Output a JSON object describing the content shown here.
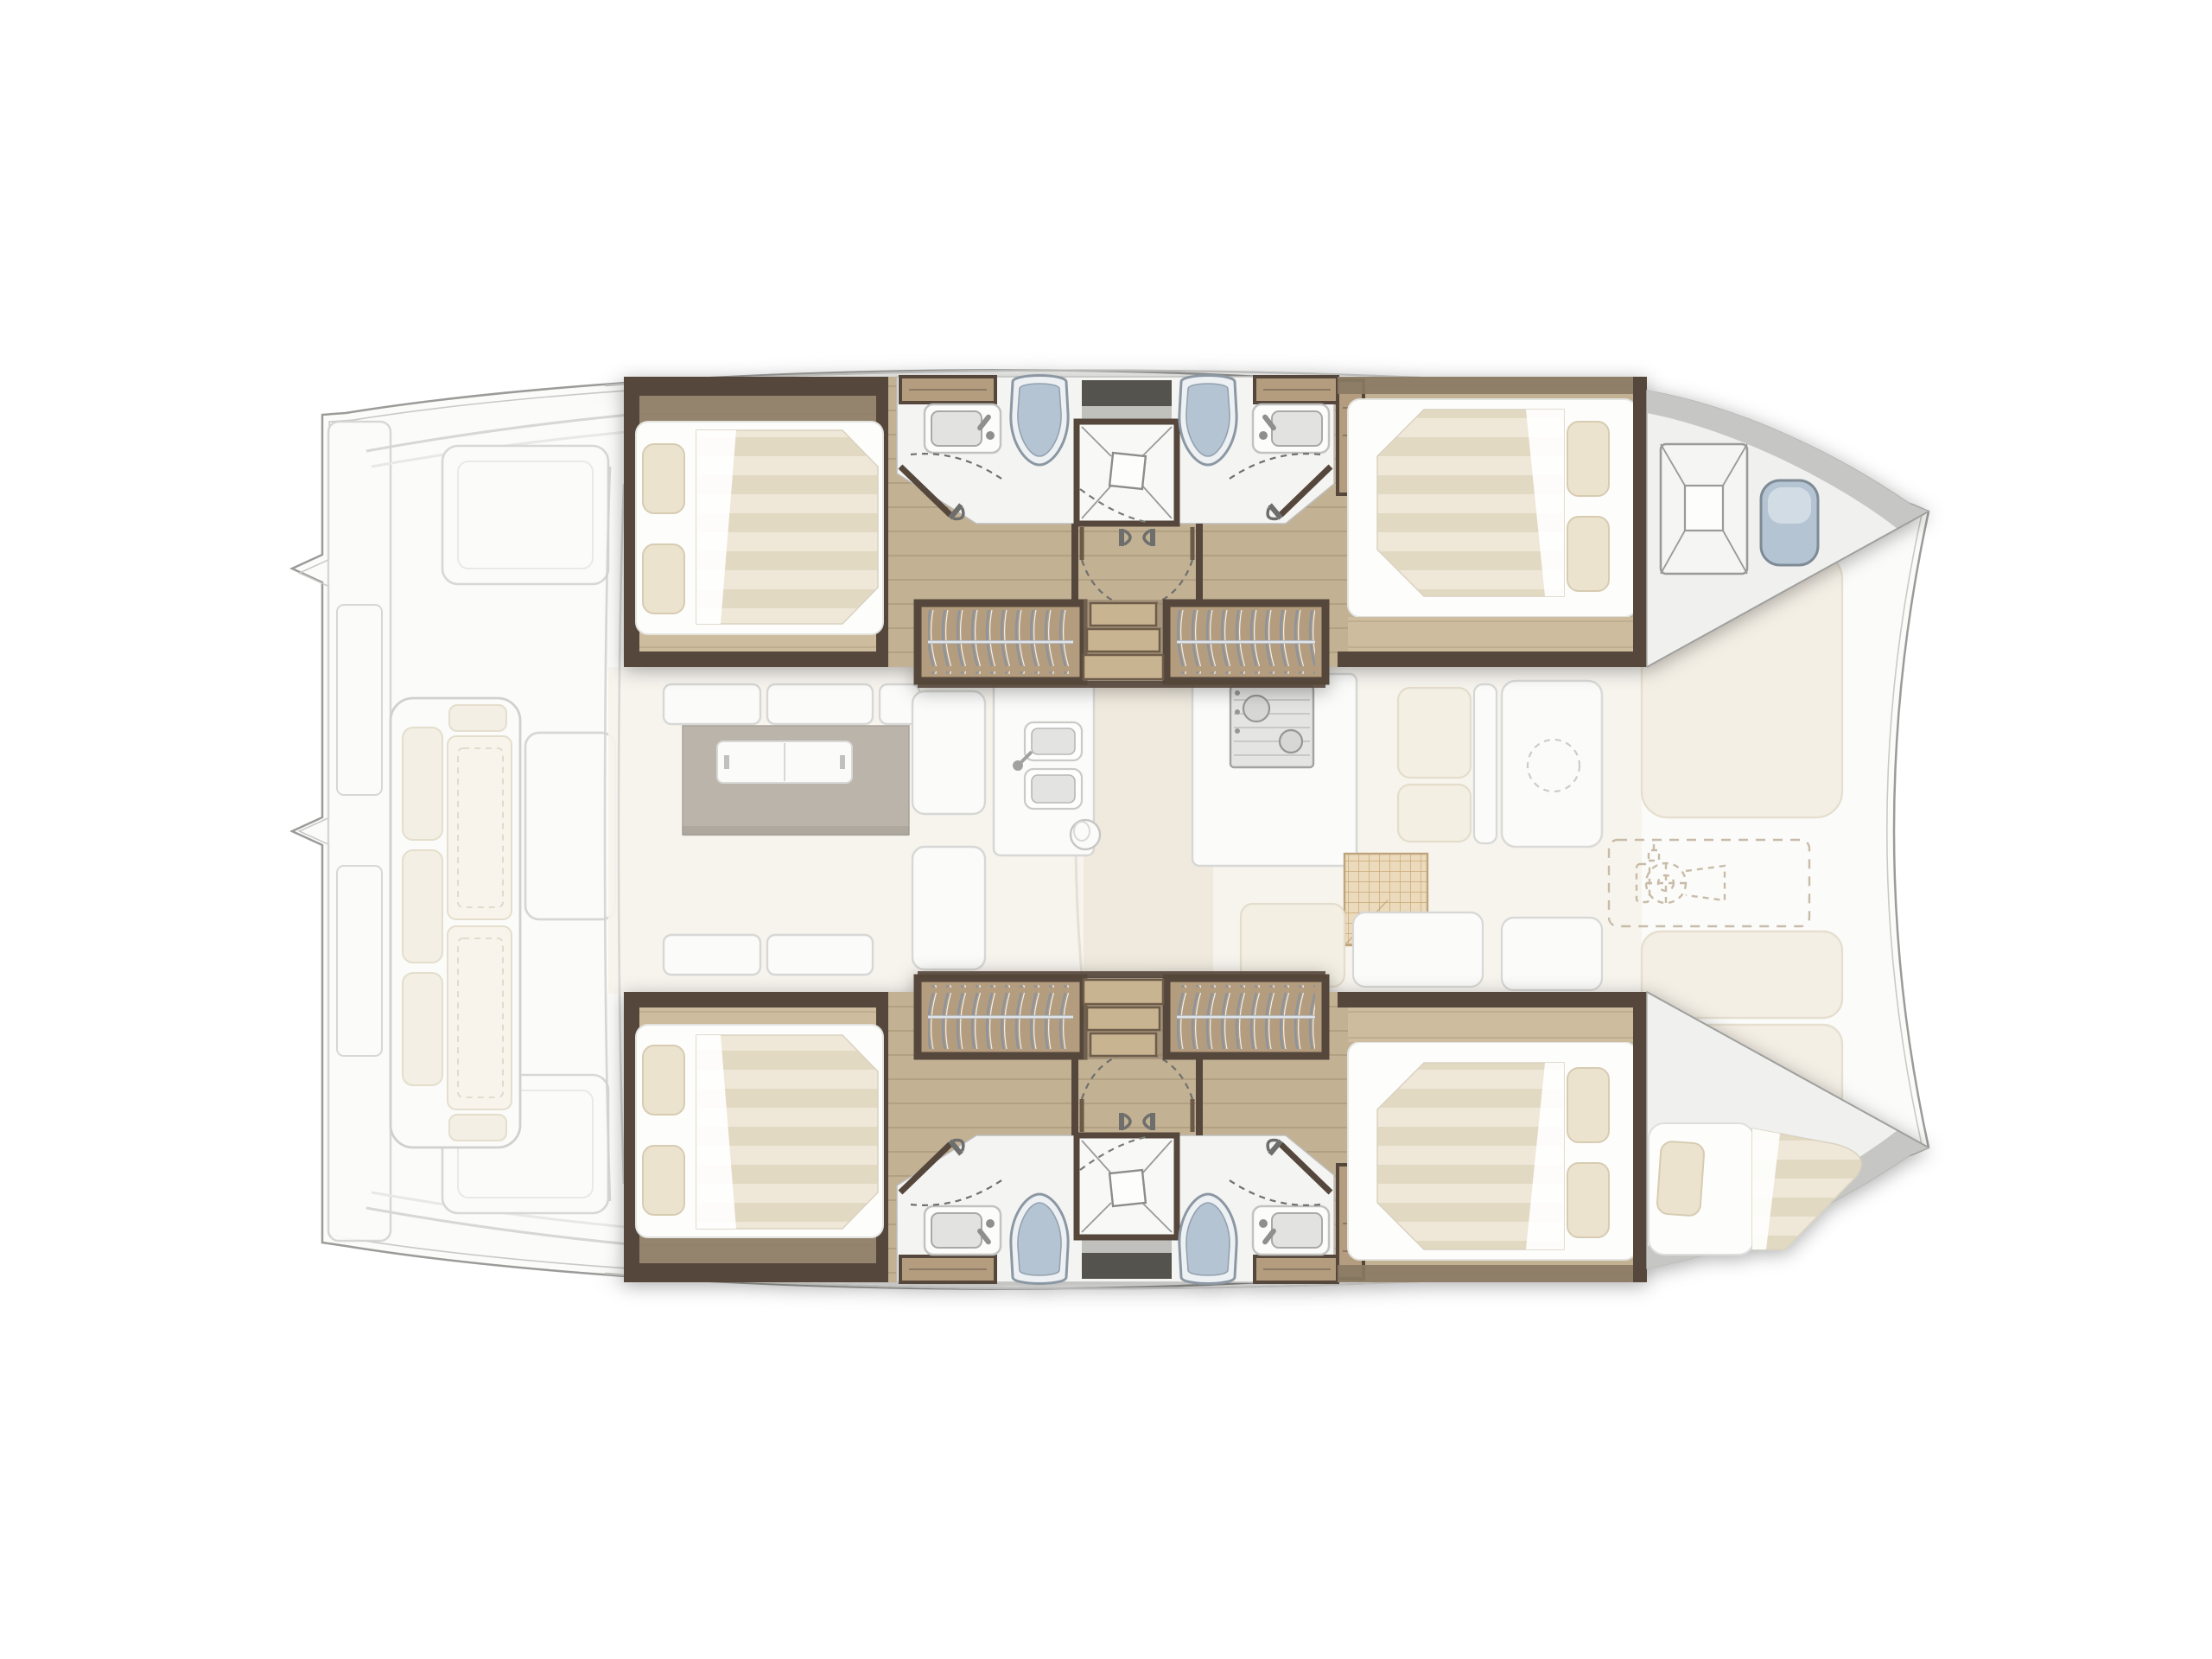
{
  "meta": {
    "vessel": "Sailing catamaran accommodation plan",
    "description": "Overhead deck and interior layout plan of a four-cabin sailing catamaran, bow pointing right; interior hull sections rendered in full colour, deck areas faded",
    "orientation": "bow-right",
    "visible_text": "none"
  },
  "accommodation_summary": {
    "double_cabins": 4,
    "heads": 4,
    "central_showers": 2,
    "forepeak_berths": 1,
    "hanging_lockers": 4,
    "companionway_stairs": 2
  },
  "areas": {
    "cockpit": {
      "name": "aft cockpit (faded)",
      "fixtures": [
        "swim platform steps",
        "transverse sofa with back pillows",
        "cockpit table",
        "two aft benches",
        "coachroof edge lines"
      ]
    },
    "salon": {
      "name": "salon and galley (faded)",
      "fixtures": [
        "dining table with sliding white tray",
        "settee cushions aft",
        "side bench",
        "galley island with twin sinks and mixer tap",
        "round waste bin",
        "stove with two burners and control knobs",
        "refrigerator vent grid",
        "chart seat cushions",
        "forward lounge panel with dashed cutout circle",
        "centreline walkway"
      ]
    },
    "foredeck": {
      "name": "foredeck (faded)",
      "fixtures": [
        "three sunpad cushions",
        "dashed anchor-locker lid outline",
        "dashed windlass icon"
      ]
    },
    "port_hull": {
      "name": "port hull (top, highlighted)",
      "sections": [
        {
          "name": "aft double cabin",
          "fixtures": [
            "island double berth",
            "two pillows",
            "white sheet fold",
            "walnut joinery frame",
            "timber sole"
          ]
        },
        {
          "name": "aft head",
          "fixtures": [
            "vanity locker",
            "wash basin with mixer",
            "marine toilet",
            "hinged door with dashed swing arc"
          ]
        },
        {
          "name": "central shower",
          "fixtures": [
            "shower tray with fall lines",
            "square drain",
            "dark skylight hatch",
            "dashed shower door"
          ]
        },
        {
          "name": "forward head",
          "fixtures": [
            "marine toilet",
            "wash basin with mixer",
            "vanity locker",
            "hinged door with dashed swing arc"
          ]
        },
        {
          "name": "companionway",
          "fixtures": [
            "double doors with handles and dashed arcs",
            "three timber steps",
            "two hanging lockers with rails and hangers"
          ]
        },
        {
          "name": "forward double cabin",
          "fixtures": [
            "island double berth",
            "two pillows",
            "entry locker",
            "timber sole"
          ]
        },
        {
          "name": "forepeak",
          "fixtures": [
            "deck hatch with cross bracing",
            "moulded bow seat",
            "grey gunwale moulding"
          ]
        }
      ]
    },
    "starboard_hull": {
      "name": "starboard hull (bottom, highlighted, mirror arrangement)",
      "sections": [
        {
          "name": "aft double cabin",
          "fixtures": [
            "island double berth",
            "two pillows"
          ]
        },
        {
          "name": "aft head",
          "fixtures": [
            "wash basin",
            "marine toilet",
            "door"
          ]
        },
        {
          "name": "central shower",
          "fixtures": [
            "shower tray",
            "square drain",
            "skylight hatch"
          ]
        },
        {
          "name": "forward head",
          "fixtures": [
            "marine toilet",
            "wash basin",
            "door"
          ]
        },
        {
          "name": "companionway",
          "fixtures": [
            "double doors",
            "steps",
            "two hanging lockers"
          ]
        },
        {
          "name": "forward double cabin",
          "fixtures": [
            "island double berth",
            "two pillows"
          ]
        },
        {
          "name": "forepeak",
          "fixtures": [
            "single berth pad",
            "pillow",
            "striped bow cushion",
            "grey gunwale moulding"
          ]
        }
      ]
    }
  },
  "palette": {
    "pageBg": "#ffffff",
    "hullFill": "#fbfbfa",
    "hullLine": "#9b9b99",
    "fadedLine": "#d4d4d2",
    "fadedFill": "#fcfcfb",
    "creamCushion": "#f3eee2",
    "creamLine": "#e3dbc8",
    "wood": "#c2b193",
    "woodLine": "#ac9a7c",
    "woodLight": "#cdbd9e",
    "walnut": "#54463a",
    "trim": "#8a7a64",
    "wardrobeWood": "#b49c7e",
    "hanger": "#8d949c",
    "rail": "#b7bec5",
    "bathFloor": "#f4f4f2",
    "fixtureLine": "#8b97a2",
    "toiletLid": "#b5c4d3",
    "toiletFill": "#eef1f4",
    "basin": "#e2e2e0",
    "mattressA": "#efe8d9",
    "mattressB": "#e2d9c3",
    "pillow": "#ece3cf",
    "pillowLine": "#d7ccb2",
    "tableGrey": "#b5aea4",
    "skylight": "#55534e",
    "gunwale": "#c6c6c4",
    "deckWhite": "#f0f0ee",
    "steel": "#9a9a98",
    "dashTan": "#c0b29a"
  }
}
